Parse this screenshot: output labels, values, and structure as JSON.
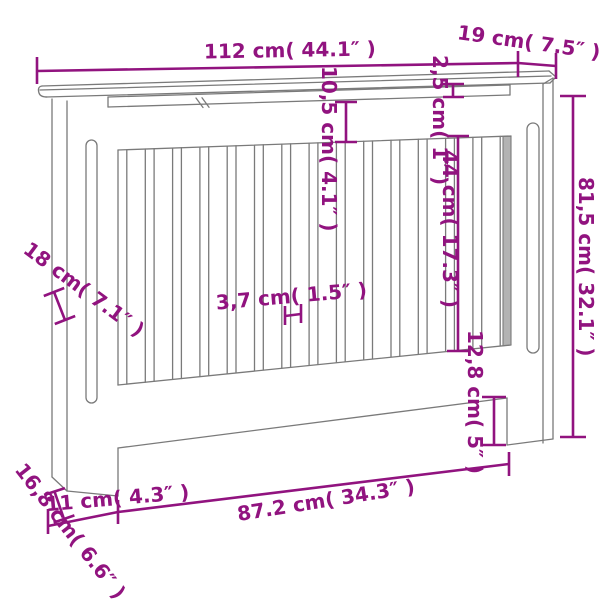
{
  "drawing_title": "radiator-cover-dimension-diagram",
  "colors": {
    "dimension_annotation": "#91137F",
    "line_art": "#7a7a7a",
    "background": "#ffffff"
  },
  "dimensions": {
    "top_width": "112 cm( 44.1″ )",
    "top_depth": "19 cm( 7.5″ )",
    "shelf_gap": "10,5 cm( 4.1″ )",
    "rail_height": "2,5 cm( 1″ )",
    "slat_length": "44 cm( 17.3″ )",
    "total_height": "81,5 cm( 32.1″ )",
    "side_depth": "18 cm( 7.1″ )",
    "slat_width": "3,7 cm( 1.5″ )",
    "foot_height": "12,8 cm( 5″ )",
    "base_depth": "16,8 cm( 6.6″ )",
    "foot_width": "11 cm( 4.3″ )",
    "opening_width": "87.2 cm( 34.3″ )"
  }
}
